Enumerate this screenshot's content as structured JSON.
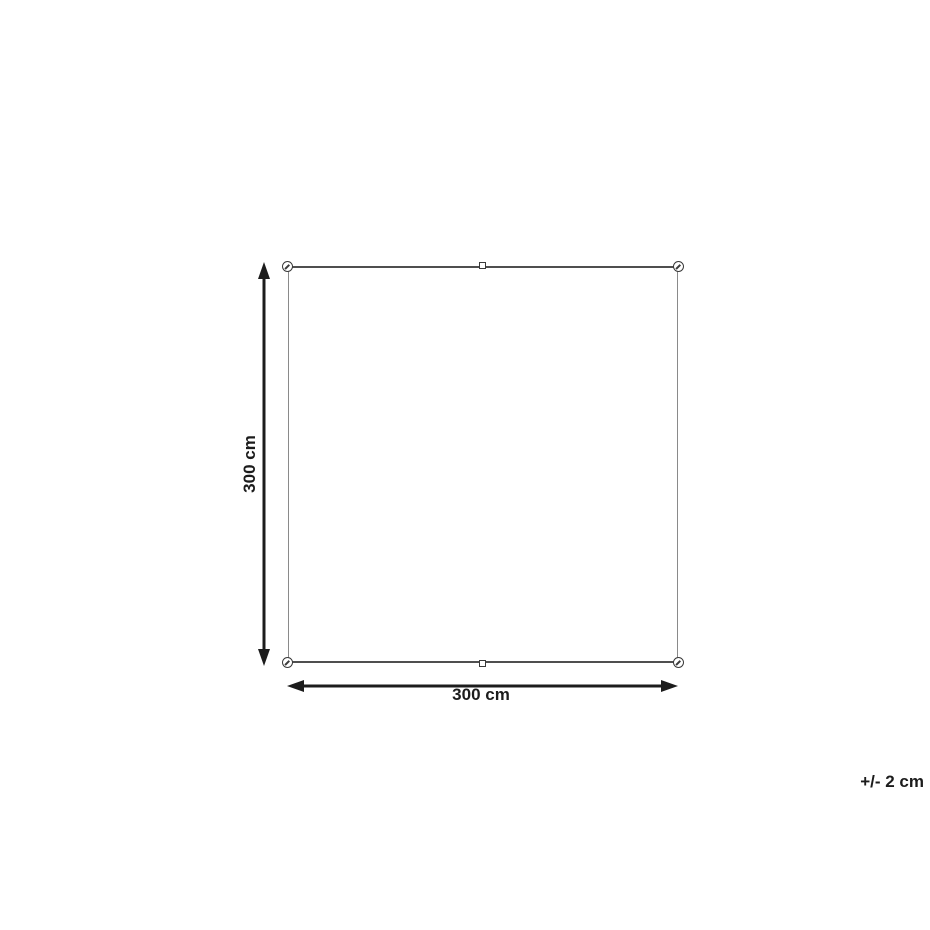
{
  "diagram": {
    "height_label": "300 cm",
    "width_label": "300 cm",
    "tolerance_label": "+/- 2 cm"
  },
  "colors": {
    "bg": "#ffffff",
    "outline-h": "#4f4f4f",
    "outline-v": "#8a8a8a",
    "grommet": "#3a3a3a",
    "arrow": "#1c1c1c",
    "text": "#1c1c1c"
  }
}
